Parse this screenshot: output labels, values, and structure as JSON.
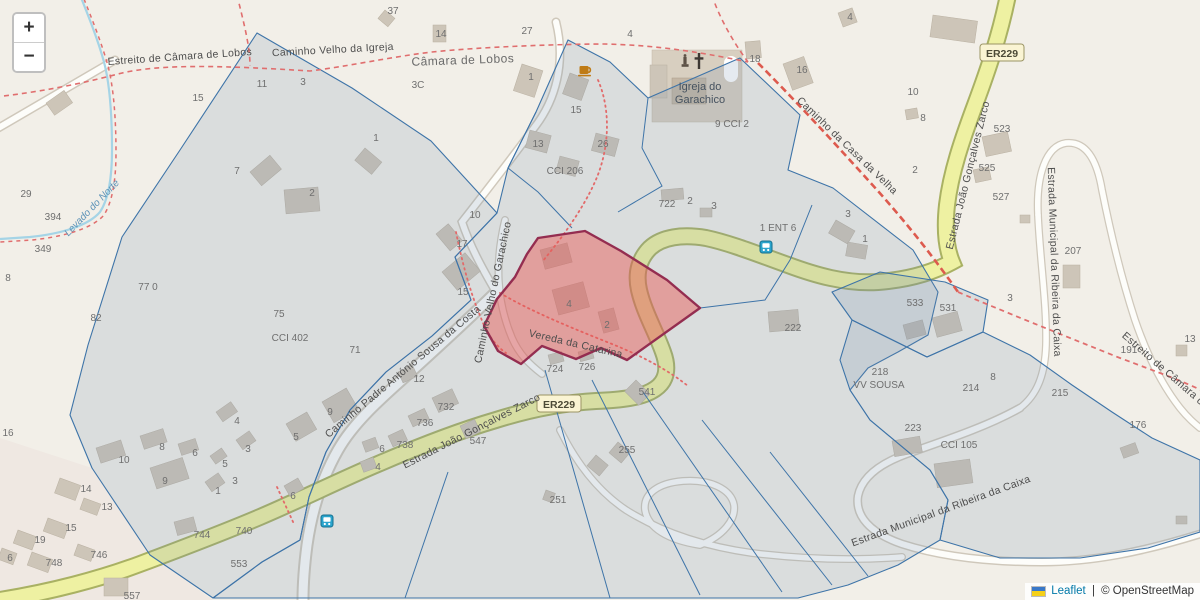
{
  "map": {
    "controls": {
      "zoom_in": "+",
      "zoom_out": "−"
    },
    "attribution": {
      "leaflet": "Leaflet",
      "sep": " | ",
      "osm": "© OpenStreetMap"
    },
    "badges": {
      "er229": "ER229"
    },
    "roads": {
      "estreito": "Estreito de Câmara de Lobos",
      "velho_igreja": "Caminho Velho da Igreja",
      "casa_velha": "Caminho da Casa da Velha",
      "zarco": "Estrada João Gonçalves Zarco",
      "municipal": "Estrada Municipal da Ribeira da Caixa",
      "garachico": "Caminho Velho do Garachico",
      "padre": "Caminho Padre António Sousa da Costa",
      "vereda": "Vereda da Catarina",
      "levada": "Levado do Norte"
    },
    "places": {
      "town": "Câmara de Lobos",
      "church_line1": "Igreja do",
      "church_line2": "Garachico"
    },
    "labels": [
      "37",
      "27",
      "4",
      "14",
      "4",
      "18",
      "16",
      "15",
      "11",
      "3",
      "3C",
      "1",
      "1",
      "15",
      "13",
      "26",
      "2",
      "7",
      "10",
      "8",
      "2",
      "10",
      "17",
      "29",
      "394",
      "349",
      "8",
      "77 0",
      "82",
      "75",
      "CCI 402",
      "71",
      "722",
      "2",
      "3",
      "1 ENT 6",
      "3",
      "1",
      "9 CCI 2",
      "CCI 206",
      "523",
      "525",
      "527",
      "207",
      "3",
      "191",
      "13",
      "215",
      "533",
      "531",
      "222",
      "218",
      "VV SOUSA",
      "214",
      "8",
      "223",
      "CCI 105",
      "176",
      "4",
      "2",
      "724",
      "726",
      "541",
      "15",
      "12",
      "732",
      "736",
      "738",
      "547",
      "255",
      "251",
      "9",
      "5",
      "6",
      "4",
      "6",
      "16",
      "10",
      "8",
      "6",
      "4",
      "3",
      "5",
      "9",
      "3",
      "1",
      "14",
      "13",
      "15",
      "19",
      "6",
      "748",
      "746",
      "744",
      "740",
      "553",
      "557"
    ]
  }
}
